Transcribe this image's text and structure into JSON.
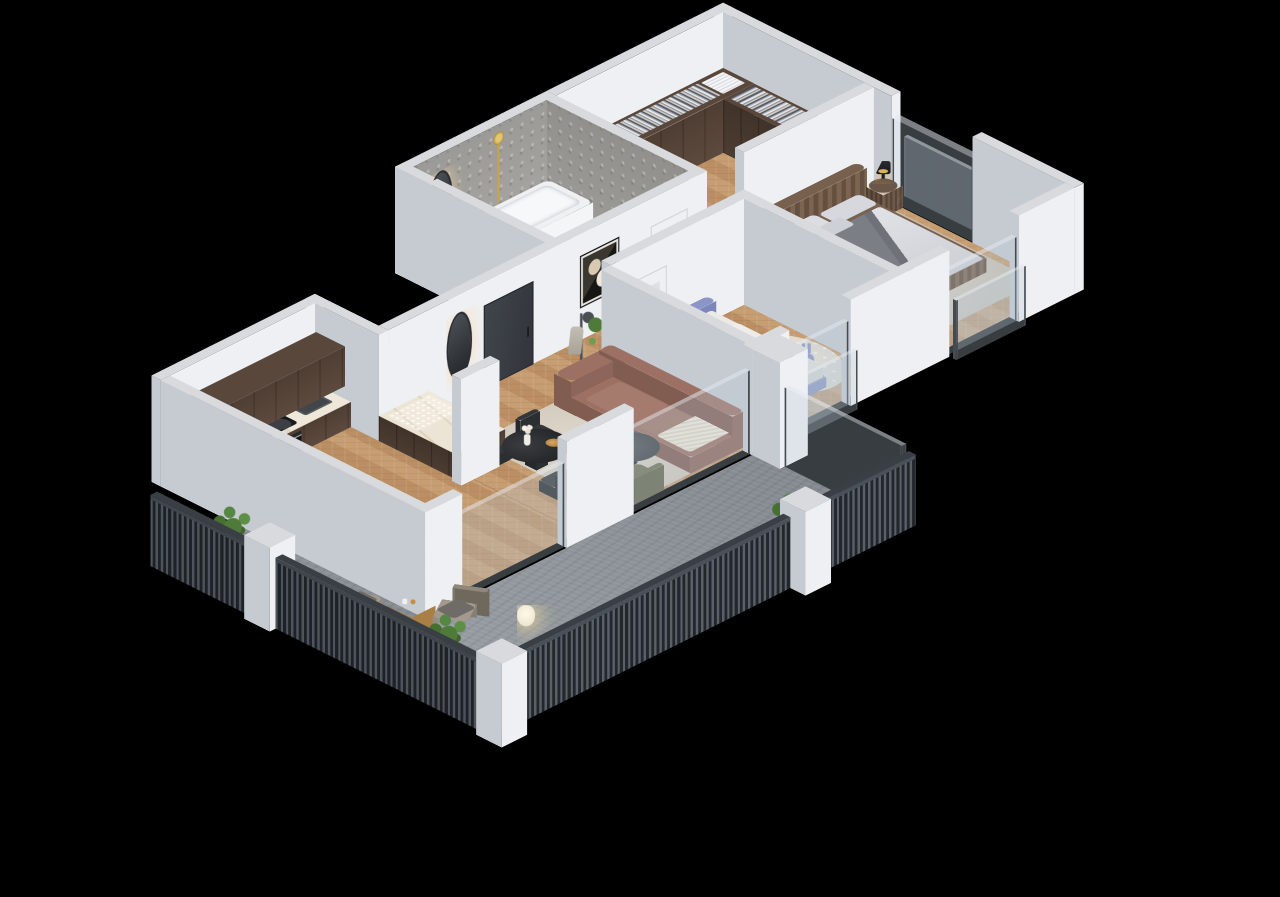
{
  "meta": {
    "type": "3d-isometric-floor-plan-render",
    "background": "#000000",
    "view": "isometric 2:1, apartment cutaway with furniture, no visible text"
  },
  "palette": {
    "wallTop": "#d8dade",
    "wallLit": "#eef0f3",
    "wallShade": "#c6cad1",
    "glass": "rgba(186,202,214,0.30)",
    "sofa": "#9c7164",
    "olive": "#6f7356",
    "kidsBlue": "#8c95c8",
    "gold": "#c9a44a",
    "woodFloor": "#c69a6c",
    "darkCabinet": "#53412f",
    "marbleCounter": "#ece5d6",
    "concreteDeck": "#8e949a",
    "railing": "#2e3338",
    "stoneBath": "#a6a5a1",
    "beddingGrey": "#d4d6da",
    "leafGreen": "#5d8f46"
  },
  "rooms": [
    {
      "label": "kitchen",
      "items": [
        "tall dark wood cabinets",
        "marble counter",
        "induction hob",
        "oven",
        "sink with gold faucet",
        "black kettle",
        "bottles",
        "bar cabinet with glasses"
      ]
    },
    {
      "label": "dining area",
      "items": [
        "round black table",
        "4 black chairs",
        "white vase with flowers",
        "amber bowl"
      ]
    },
    {
      "label": "living room",
      "items": [
        "terracotta sofa with bolsters",
        "cream throw",
        "round dark coffee table",
        "2 olive armchairs",
        "beige rug",
        "tall potted plant"
      ]
    },
    {
      "label": "entry hall",
      "items": [
        "charcoal front door",
        "backlit oval mirror",
        "coat stand with hat and coat",
        "abstract framed art"
      ]
    },
    {
      "label": "kids bedroom",
      "items": [
        "blue single bed",
        "grey pillow",
        "open wardrobe with clothes",
        "round cream rug",
        "toy blocks",
        "bunny chair",
        "black floor lamp",
        "basket",
        "white door"
      ]
    },
    {
      "label": "master bedroom",
      "items": [
        "double bed with channel-tufted brown frame",
        "grey bedding with dark throw",
        "two fluted nightstands",
        "black and gold table lamps",
        "beige carpet"
      ]
    },
    {
      "label": "bathroom",
      "items": [
        "grey stone walls",
        "white bathtub",
        "floating wood vanity",
        "round white basin",
        "oval mirror",
        "gold shower column",
        "toilet",
        "white paneled door",
        "terrazzo floor"
      ]
    },
    {
      "label": "walk-in closet",
      "items": [
        "dark wood wardrobes with hanging clothes",
        "towel stack",
        "herringbone floor"
      ]
    },
    {
      "label": "balcony",
      "items": [
        "concrete deck",
        "dark slatted railing",
        "white pillars",
        "3 planter boxes with shrubs",
        "2 rope armchairs with grey cushions",
        "round wooden side table",
        "glowing lantern",
        "glass balustrade"
      ]
    }
  ],
  "windows": [
    "living room sliding glass",
    "kids room window with juliet glass",
    "master bedroom front window",
    "master bedroom side window"
  ]
}
